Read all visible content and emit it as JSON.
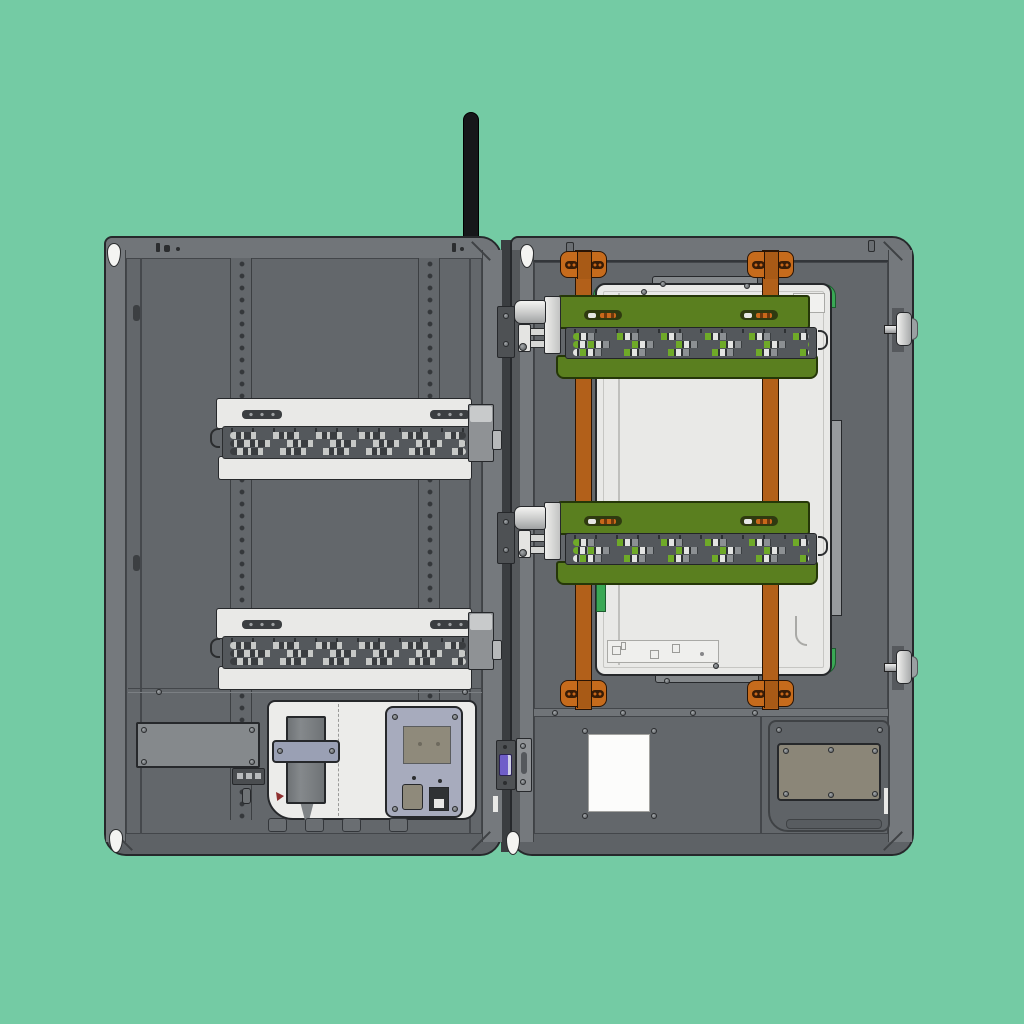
{
  "meta": {
    "title": "CAD rendering of a wall-mount electronics enclosure with both doors open",
    "style": "flat technical illustration, no visible text labels"
  },
  "colors": {
    "bg": "#74cba4",
    "ink": "#26282b",
    "frame": "#696d71",
    "frameLight": "#75797d",
    "frameDark": "#5e6266",
    "face": "#63676b",
    "faceDark": "#5f6367",
    "seam": "#45484c",
    "white": "#e9e9e7",
    "whiteDim": "#c9cbc9",
    "band": "#54585c",
    "pill": "#c7c9c7",
    "olive": "#5a7f1f",
    "oliveInk": "#2a3d0a",
    "green": "#3aa855",
    "orange": "#b2601a",
    "orangeLit": "#c66b1c",
    "orangeInk": "#2a1404",
    "blue": "#a7abbd",
    "beige": "#8b8678",
    "purple": "#6f5ec9",
    "metal": "#d9dadb",
    "metalDark": "#8f9295",
    "black": "#16171a"
  },
  "components": {
    "antenna": {
      "count": 1,
      "color": "black",
      "position": "top center, above hinge column"
    },
    "left_door": {
      "perforated_mounting_rails": 2,
      "white_terminal_blocks": 2,
      "blank_cover_plate": 1,
      "terminal_strip_3way": 1,
      "white_mounting_plate": 1,
      "clamped_sensor_unit": 1,
      "controller_module_with_rj45": 1,
      "hinge_pins": 2
    },
    "right_door": {
      "orange_din_rails": 2,
      "rail_mounting_brackets": 4,
      "green_io_terminal_modules": 2,
      "module_end_latch_cylinders": 2,
      "white_back_panel": 1,
      "green_corner_accents": 4,
      "label_card": 1,
      "access_panel_beige": 1,
      "edge_latches": 2
    },
    "center_column": {
      "purple_connector": 1,
      "latch_plate": 1,
      "hinge_pins": 2
    }
  }
}
